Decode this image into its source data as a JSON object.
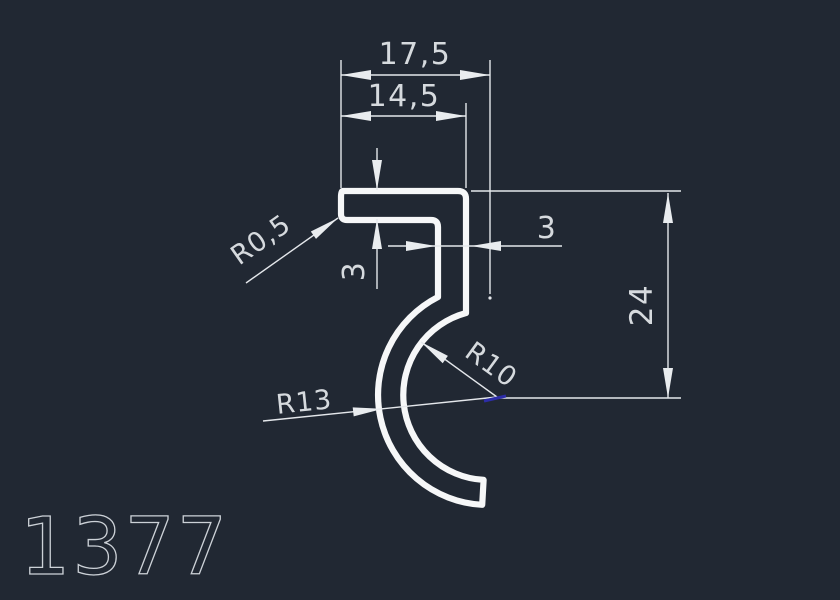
{
  "title": {
    "part_number": "1377"
  },
  "drawing": {
    "dimensions": {
      "width_overall": "17,5",
      "width_top": "14,5",
      "thickness_top": "3",
      "thickness_wall": "3",
      "height_overall": "24",
      "radius_corner": "R0,5",
      "radius_outer": "R13",
      "radius_inner": "R10"
    },
    "colors": {
      "background": "#212833",
      "profile_line": "#f6f7f8",
      "dimension_line": "#e4e7eb",
      "text": "#d6dade",
      "accent_blue": "#2d2da8"
    }
  }
}
